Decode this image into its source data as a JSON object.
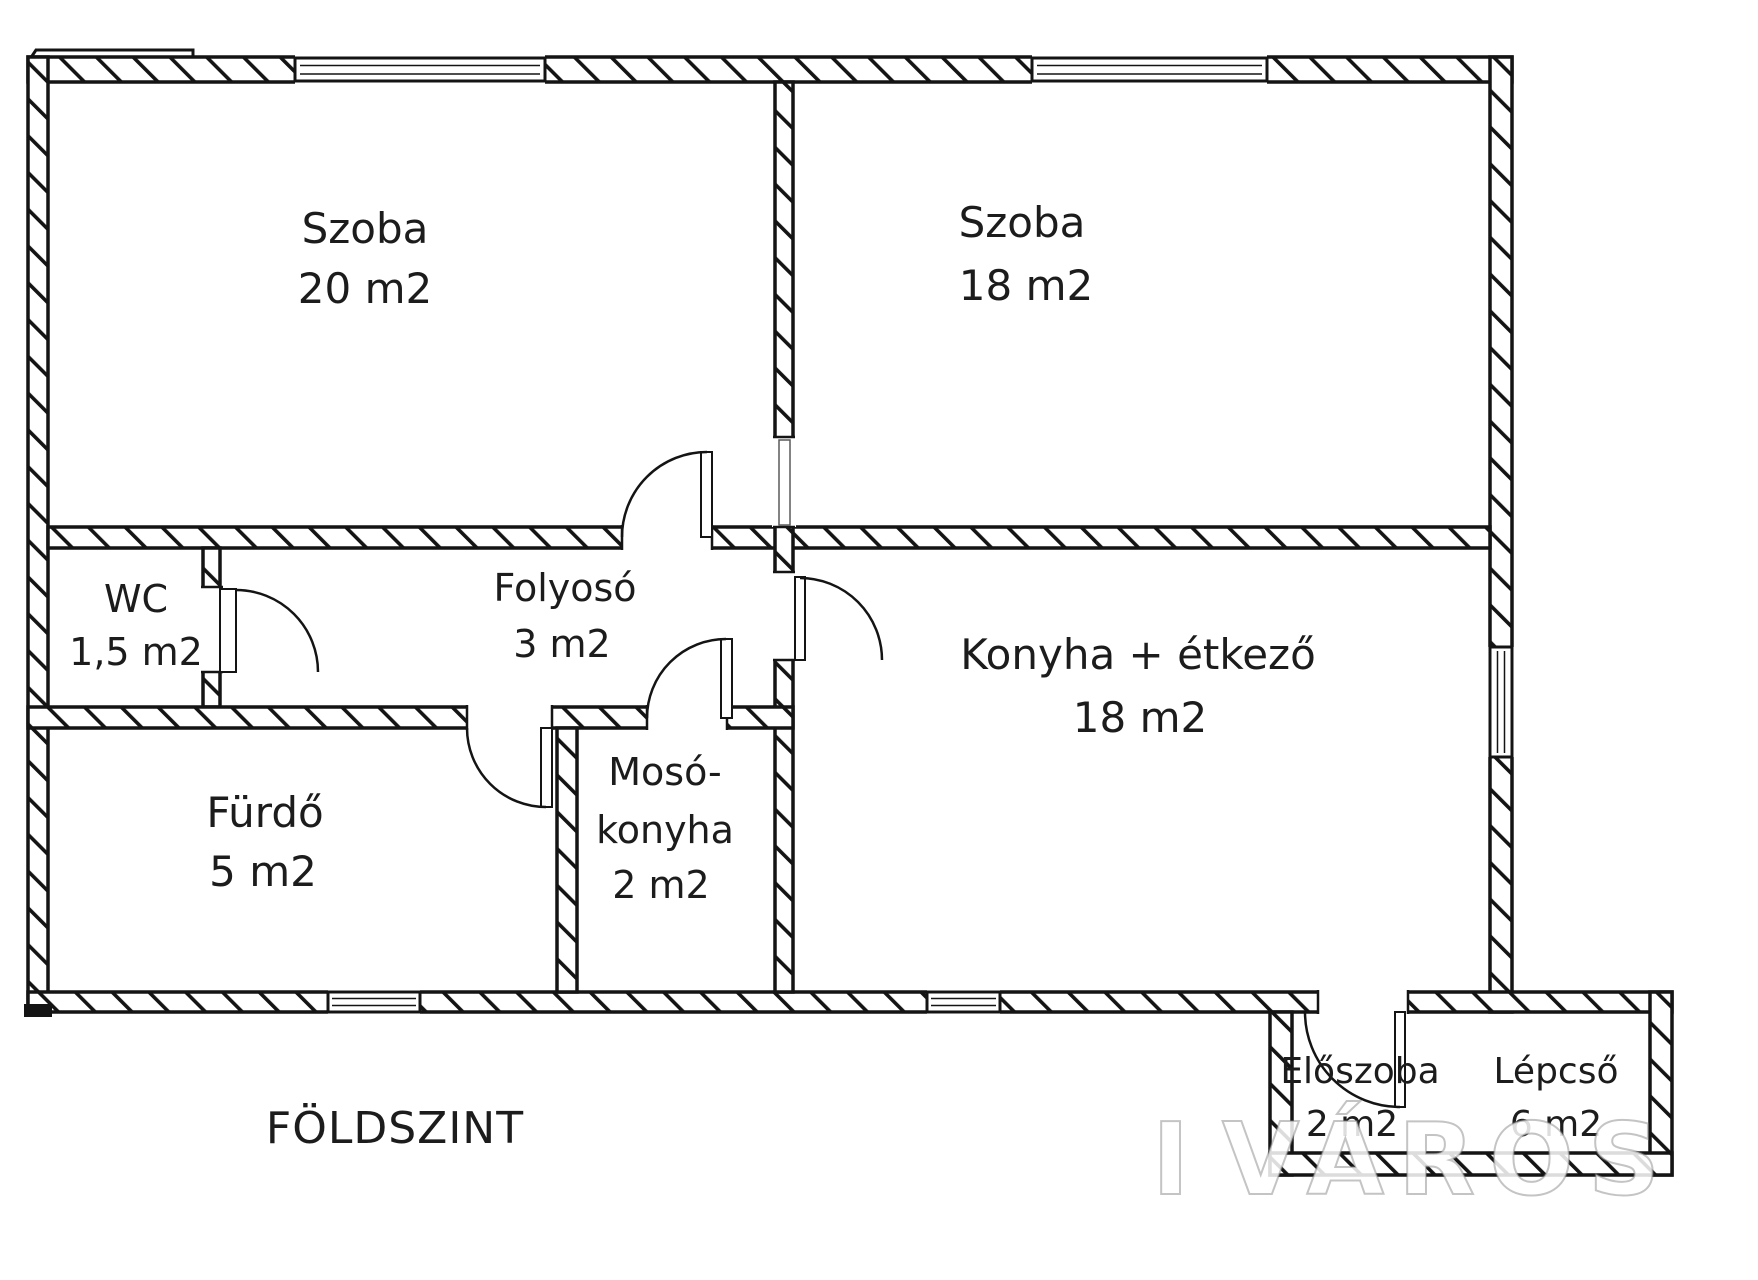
{
  "floor_label": "FÖLDSZINT",
  "watermark": {
    "text": "VÁROS",
    "fragment": "I"
  },
  "colors": {
    "wall_line": "#141414",
    "label_text": "#1c1c1c",
    "background": "#ffffff",
    "watermark_fill": "#ffffff"
  },
  "rooms": {
    "szoba20": {
      "name": "Szoba",
      "area": "20 m2"
    },
    "szoba18": {
      "name": "Szoba",
      "area": "18 m2"
    },
    "wc": {
      "name": "WC",
      "area": "1,5 m2"
    },
    "folyoso": {
      "name": "Folyosó",
      "area": "3 m2"
    },
    "furdo": {
      "name": "Fürdő",
      "area": "5 m2"
    },
    "mosokonyha": {
      "name_line1": "Mosó-",
      "name_line2": "konyha",
      "area": "2 m2"
    },
    "konyha": {
      "name": "Konyha + étkező",
      "area": "18 m2"
    },
    "eloszoba": {
      "name": "Előszoba",
      "area": "2 m2"
    },
    "lepcso": {
      "name": "Lépcső",
      "area": "6 m2"
    }
  }
}
